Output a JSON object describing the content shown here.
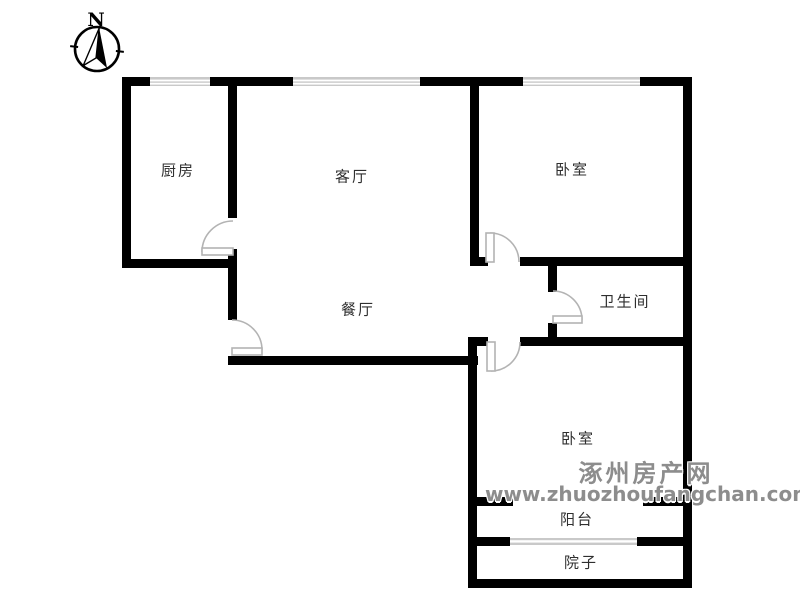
{
  "compass": {
    "label": "N"
  },
  "rooms": {
    "kitchen": {
      "label": "厨房"
    },
    "living": {
      "label": "客厅"
    },
    "bedroom_top": {
      "label": "卧室"
    },
    "dining": {
      "label": "餐厅"
    },
    "bathroom": {
      "label": "卫生间"
    },
    "bedroom_bottom": {
      "label": "卧室"
    },
    "balcony": {
      "label": "阳台"
    },
    "yard": {
      "label": "院子"
    }
  },
  "watermark": {
    "line1": "涿州房产网",
    "line2": "www.zhuozhoufangchan.com"
  },
  "colors": {
    "wall": "#000000",
    "window": "#c9c9c9",
    "door": "#b3b3b3",
    "label_text": "#2f2f2f",
    "watermark": "#8d8d8d"
  }
}
